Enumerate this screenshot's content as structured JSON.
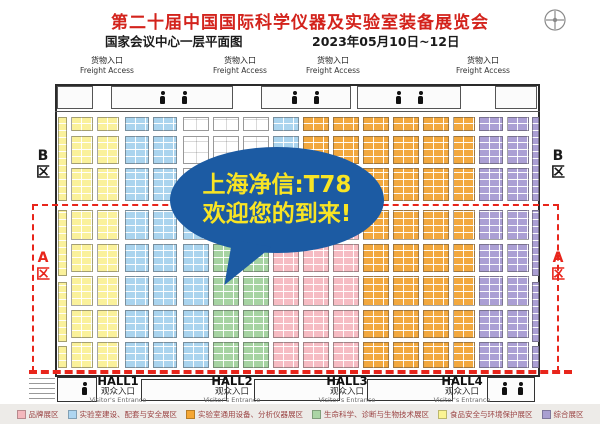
{
  "header": {
    "title": "第二十届中国国际科学仪器及实验室装备展览会",
    "venue": "国家会议中心一层平面图",
    "dates": "2023年05月10日~12日"
  },
  "bubble": {
    "line1": "上海净信:T78",
    "line2": "欢迎您的到来!",
    "bg_color": "#1c5ba3",
    "text_color": "#f8e424"
  },
  "freight": {
    "zh": "货物入口",
    "en": "Freight Access",
    "positions": [
      107,
      240,
      333,
      483
    ]
  },
  "zones": {
    "b_label": "B区",
    "a_label": "A区",
    "a_color": "#e8251b",
    "b_color": "#1a1a1a"
  },
  "halls": {
    "zh": "观众入口",
    "en": "Visitor's Entrance",
    "names": [
      "HALL1",
      "HALL2",
      "HALL3",
      "HALL4"
    ],
    "centers": [
      118,
      232,
      347,
      462
    ]
  },
  "legend": {
    "items": [
      {
        "label": "品牌展区",
        "color": "#f4b8bd"
      },
      {
        "label": "实验室建设、配套与安全展区",
        "color": "#aed6f1"
      },
      {
        "label": "实验室通用设备、分析仪器展区",
        "color": "#f5a733"
      },
      {
        "label": "生命科学、诊断与生物技术展区",
        "color": "#abd5a5"
      },
      {
        "label": "食品安全与环境保护展区",
        "color": "#fbf493"
      },
      {
        "label": "综合展区",
        "color": "#a99fd1"
      }
    ]
  },
  "floor_plan": {
    "colors": {
      "yellow": "#faf19b",
      "blue": "#aad4ee",
      "green": "#a6d3a2",
      "orange": "#f2a83e",
      "pink": "#f6bcc3",
      "purple": "#ab9fd4",
      "white": "#ffffff"
    },
    "bands_b": [
      [
        117,
        14
      ],
      [
        136,
        28
      ],
      [
        168,
        33
      ]
    ],
    "bands_a": [
      [
        210,
        30
      ],
      [
        244,
        28
      ],
      [
        276,
        30
      ],
      [
        310,
        28
      ],
      [
        342,
        26
      ]
    ],
    "columns": [
      [
        71,
        22,
        "yellow",
        "yellow"
      ],
      [
        97,
        22,
        "yellow",
        "yellow"
      ],
      [
        125,
        24,
        "blue",
        "blue"
      ],
      [
        153,
        24,
        "blue",
        "blue"
      ],
      [
        183,
        26,
        "white",
        "blue"
      ],
      [
        213,
        26,
        "white",
        "green"
      ],
      [
        243,
        26,
        "white",
        "green"
      ],
      [
        273,
        26,
        "blue",
        "pink"
      ],
      [
        303,
        26,
        "orange",
        "pink"
      ],
      [
        333,
        26,
        "orange",
        "pink"
      ],
      [
        363,
        26,
        "orange",
        "orange"
      ],
      [
        393,
        26,
        "orange",
        "orange"
      ],
      [
        423,
        26,
        "orange",
        "orange"
      ],
      [
        453,
        22,
        "orange",
        "orange"
      ],
      [
        479,
        24,
        "purple",
        "purple"
      ],
      [
        507,
        22,
        "purple",
        "purple"
      ]
    ],
    "strips": [
      {
        "x": 58,
        "w": 9,
        "color": "yellow",
        "bands": [
          [
            117,
            84
          ],
          [
            210,
            66
          ],
          [
            282,
            60
          ],
          [
            346,
            22
          ]
        ]
      },
      {
        "x": 532,
        "w": 7,
        "color": "purple",
        "bands": [
          [
            117,
            84
          ],
          [
            210,
            66
          ],
          [
            282,
            60
          ],
          [
            346,
            22
          ]
        ]
      }
    ]
  }
}
